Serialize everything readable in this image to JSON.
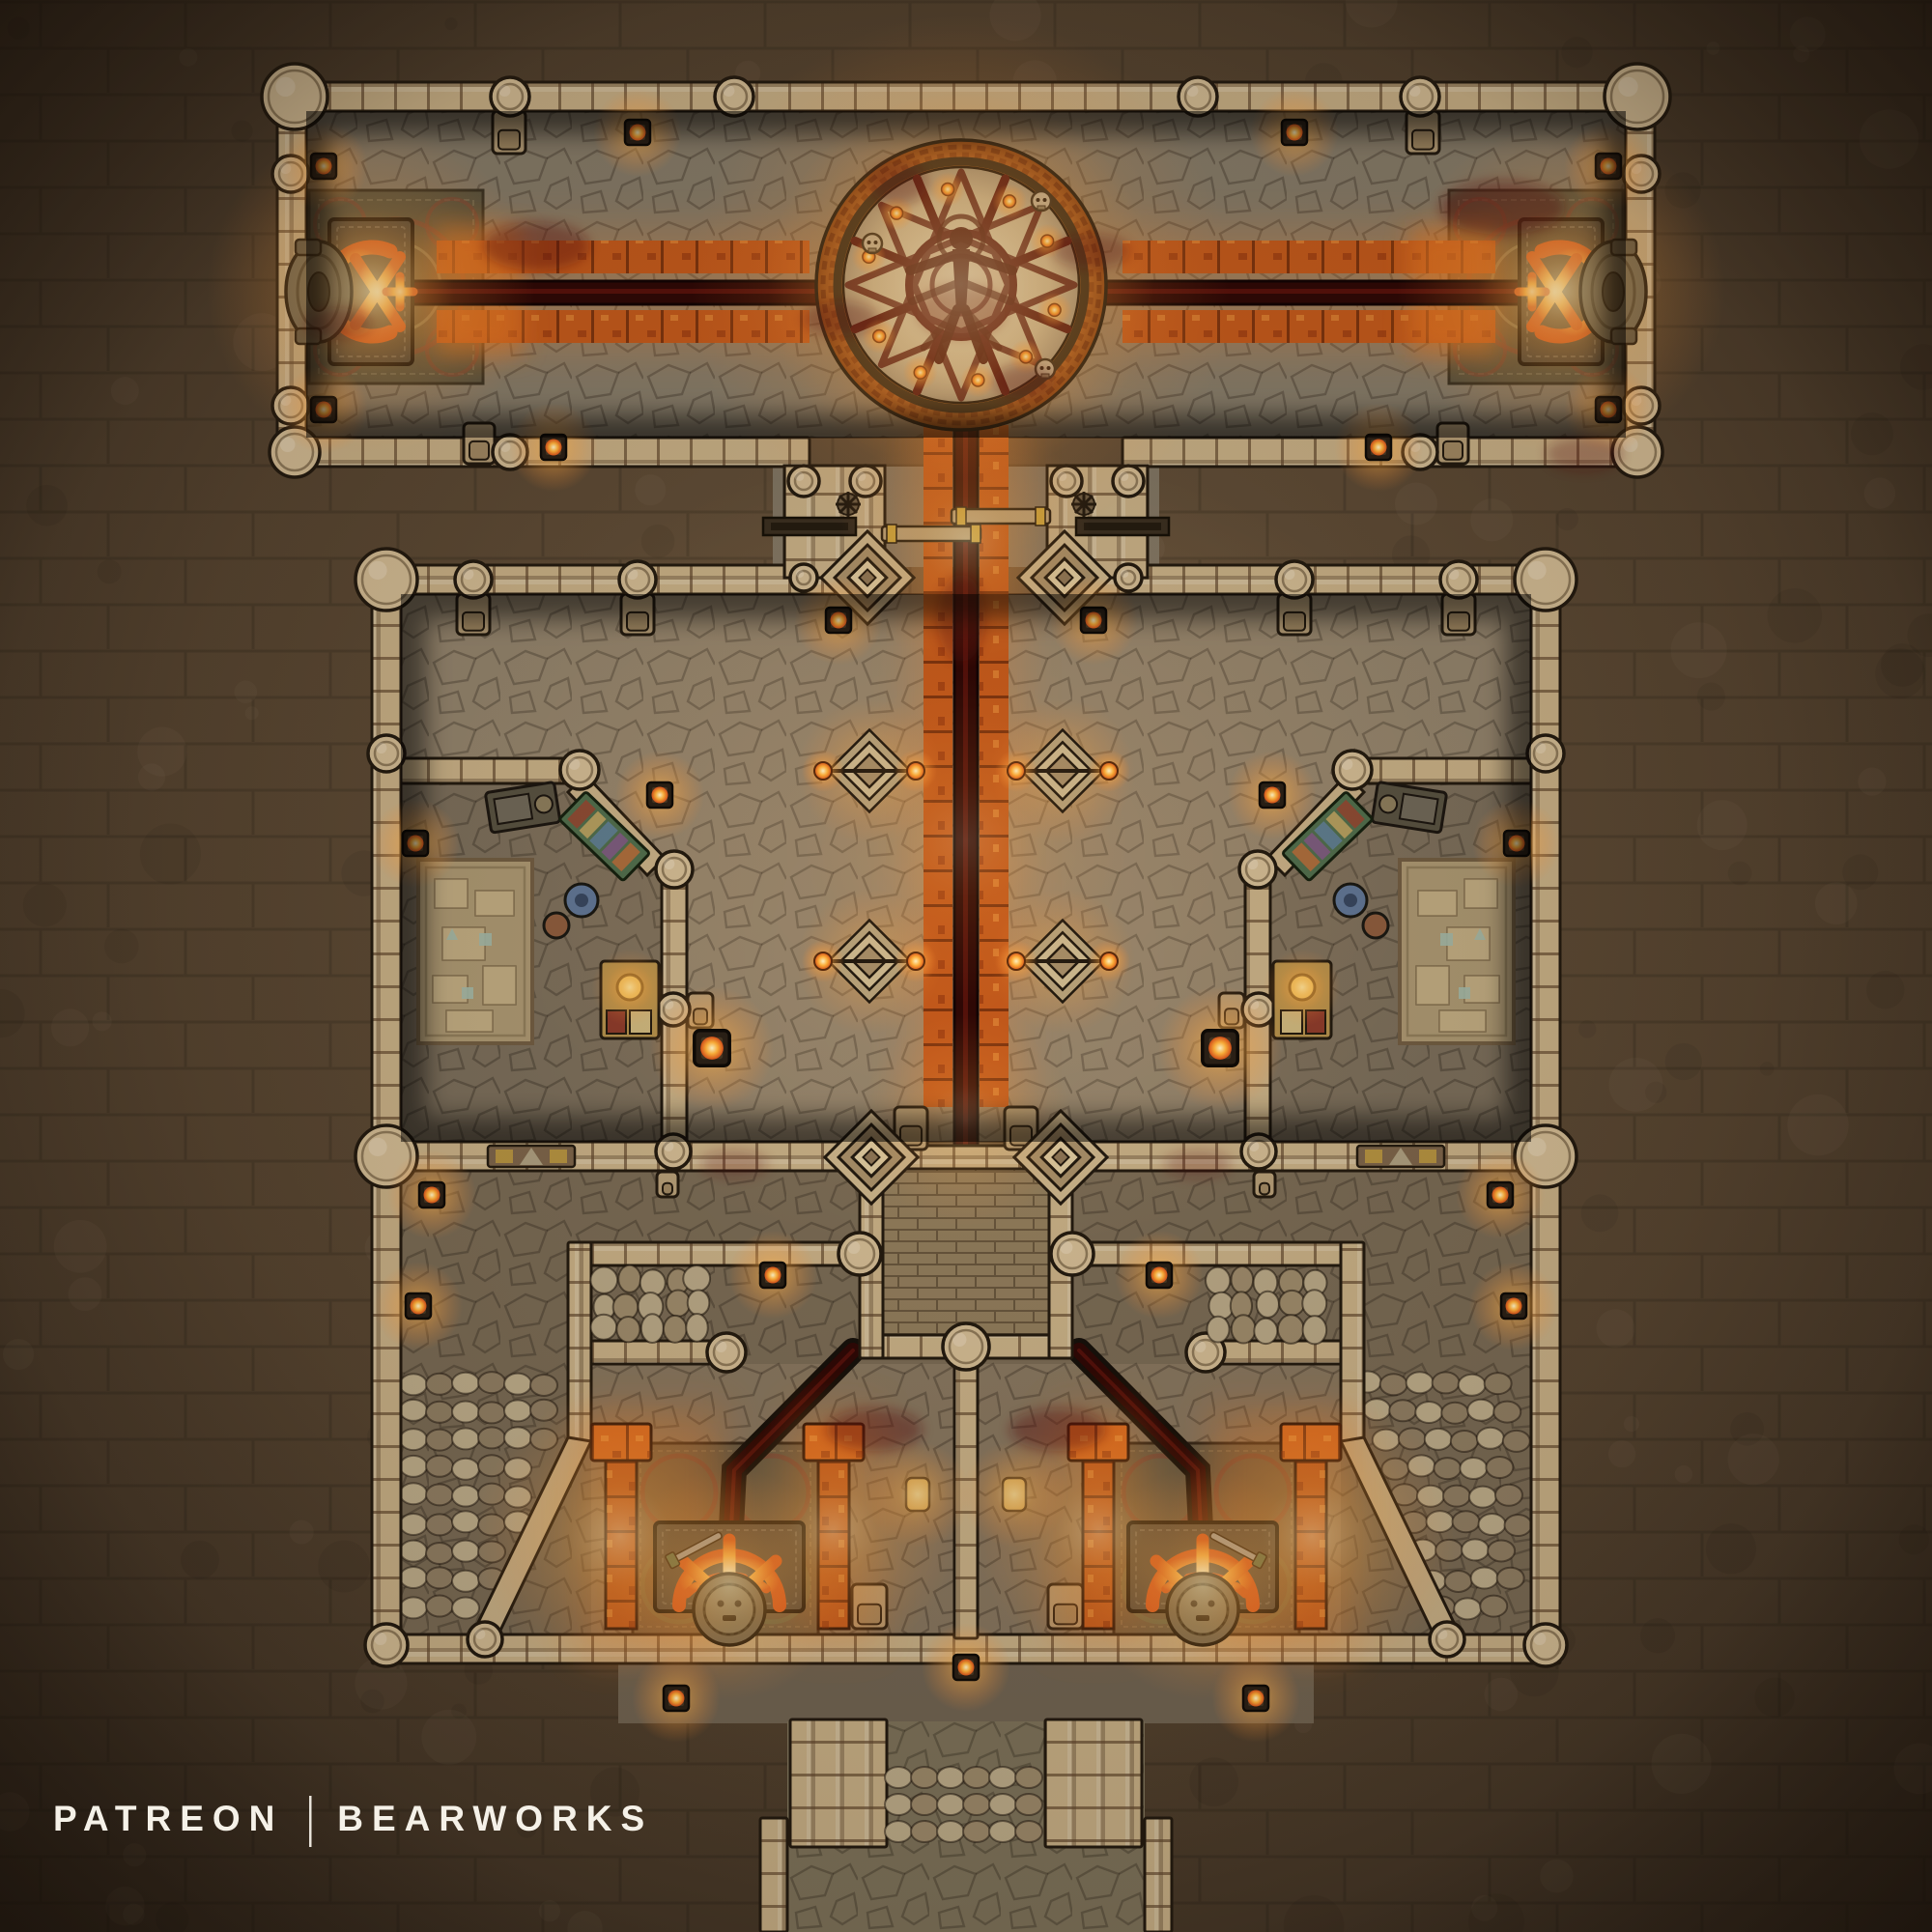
{
  "footer": {
    "brand": "PATREON",
    "separator": "|",
    "studio": "BEARWORKS"
  },
  "map": {
    "type": "dungeon-battle-map",
    "theme": "blood ritual temple, top-down tabletop map",
    "features": {
      "ritual_circle": "blood ritual circle with vitruvian figure sigil",
      "blood_channel": "dark blood channel",
      "ember_path": "glowing ember tile path",
      "altar_west": "sacrificial altar (west wing)",
      "altar_east": "sacrificial altar (east wing)",
      "gate": "double sliding bar gate",
      "side_chamber_west": "west study chamber",
      "side_chamber_east": "east study chamber",
      "floor_brazier": "ornate floor brazier",
      "central_platform": "walled central platform",
      "gear_shrine_west": "glowing gear shrine (southwest)",
      "gear_shrine_east": "glowing gear shrine (southeast)",
      "pillar": "glowing ember pillar",
      "palisade": "boulder palisade railing",
      "stairs": "boulder stairs",
      "south_passage": "south exit passage",
      "torch": "wall torch",
      "tower": "round wall tower"
    },
    "palette": {
      "background": "#54432f",
      "wall": "#c3ab82",
      "wall_line": "#231a0f",
      "floor": "#8b7d66",
      "ember": "#ff9433",
      "flame": "#ffd98a",
      "blood": "#2e0805",
      "blood_light": "#7a1a10",
      "parchment": "#d8c9ab",
      "sigil": "#551410",
      "rug_teal": "#56523f",
      "rug_red": "#7a4434",
      "text": "#f5f1e8"
    }
  }
}
